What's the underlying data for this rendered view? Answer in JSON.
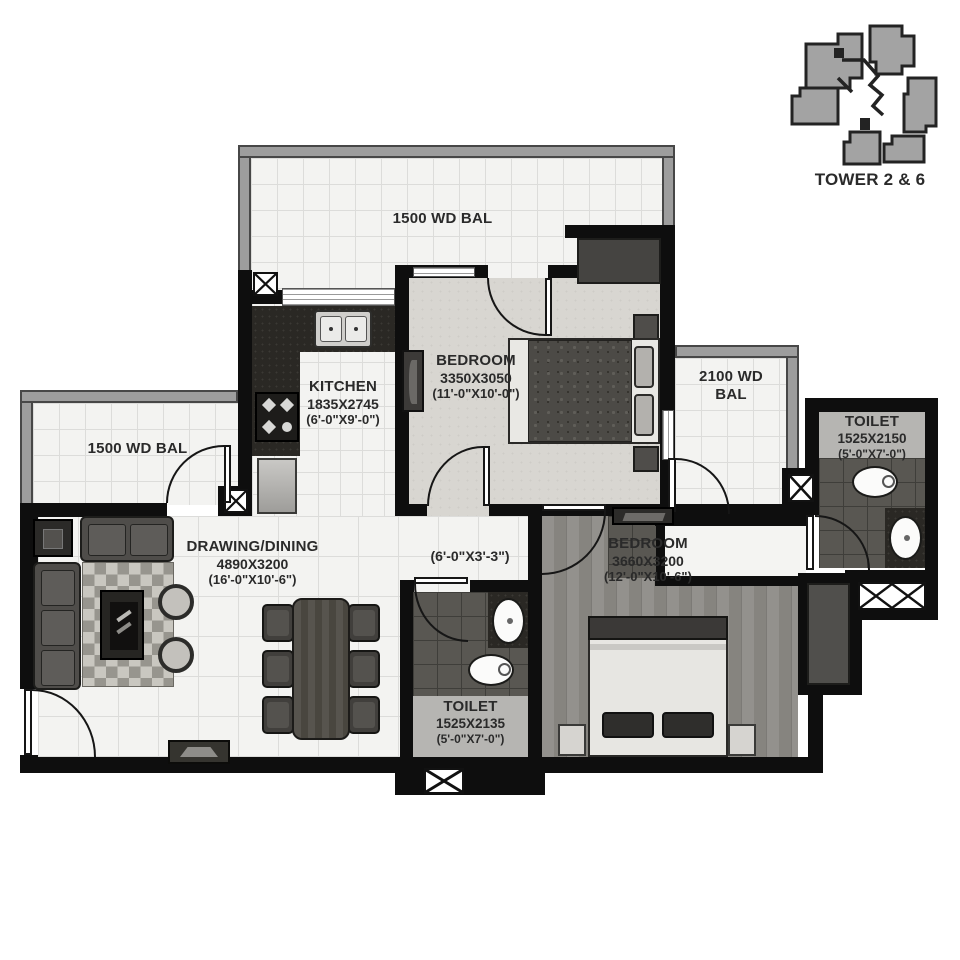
{
  "keyplan": {
    "tower_label": "TOWER 2 & 6"
  },
  "labels": {
    "balcony_top": "1500 WD BAL",
    "balcony_left": "1500 WD BAL",
    "balcony_right_line1": "2100 WD",
    "balcony_right_line2": "BAL"
  },
  "rooms": {
    "bedroom1": {
      "name": "BEDROOM",
      "size_mm": "3350X3050",
      "size_ft": "(11'-0\"X10'-0\")"
    },
    "kitchen": {
      "name": "KITCHEN",
      "size_mm": "1835X2745",
      "size_ft": "(6'-0\"X9'-0\")"
    },
    "toilet_top": {
      "name": "TOILET",
      "size_mm": "1525X2150",
      "size_ft": "(5'-0\"X7'-0\")"
    },
    "drawing_dining": {
      "name": "DRAWING/DINING",
      "size_mm": "4890X3200",
      "size_ft": "(16'-0\"X10'-6\")"
    },
    "passage": {
      "size_ft": "(6'-0\"X3'-3\")"
    },
    "bedroom2": {
      "name": "BEDROOM",
      "size_mm": "3660X3200",
      "size_ft": "(12'-0\"X10'-6\")"
    },
    "toilet_bottom": {
      "name": "TOILET",
      "size_mm": "1525X2135",
      "size_ft": "(5'-0\"X7'-0\")"
    }
  },
  "colors": {
    "wall": "#0e0e0e",
    "balcony_frame": "#9d9d9d",
    "dark_tile": "#595752",
    "wood_floor": "#8d8b87",
    "label_text": "#2a2a2a",
    "keyplan_unit": "#a3a3a3"
  }
}
